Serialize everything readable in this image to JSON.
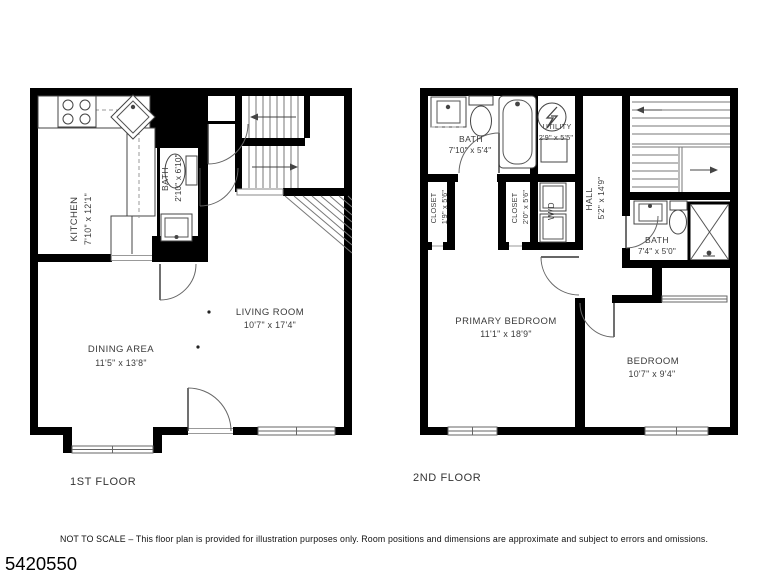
{
  "floors": [
    {
      "label": "1ST FLOOR",
      "rooms": [
        {
          "name": "KITCHEN",
          "dims": "7'10\" x 12'1\""
        },
        {
          "name": "BATH",
          "dims": "2'10\" x 6'10\""
        },
        {
          "name": "LIVING ROOM",
          "dims": "10'7\" x 17'4\""
        },
        {
          "name": "DINING AREA",
          "dims": "11'5\" x 13'8\""
        }
      ]
    },
    {
      "label": "2ND FLOOR",
      "rooms": [
        {
          "name": "BATH",
          "dims": "7'10\" x 5'4\""
        },
        {
          "name": "UTILITY",
          "dims": "2'9\" x 5'5\""
        },
        {
          "name": "CLOSET",
          "dims": "1'9\" x 5'6\""
        },
        {
          "name": "CLOSET",
          "dims": "2'0\" x 5'6\""
        },
        {
          "name": "W/D"
        },
        {
          "name": "HALL",
          "dims": "5'2\" x 14'9\""
        },
        {
          "name": "BATH",
          "dims": "7'4\" x 5'0\""
        },
        {
          "name": "PRIMARY BEDROOM",
          "dims": "11'1\" x 18'9\""
        },
        {
          "name": "BEDROOM",
          "dims": "10'7\" x 9'4\""
        }
      ]
    }
  ],
  "footer": {
    "disclaimer": "NOT TO SCALE – This floor plan is provided for illustration purposes only. Room positions and dimensions are approximate and subject to errors and omissions.",
    "listing_id": "5420550"
  },
  "colors": {
    "wall": "#000000",
    "label": "#3a3a3a",
    "background": "#ffffff"
  }
}
